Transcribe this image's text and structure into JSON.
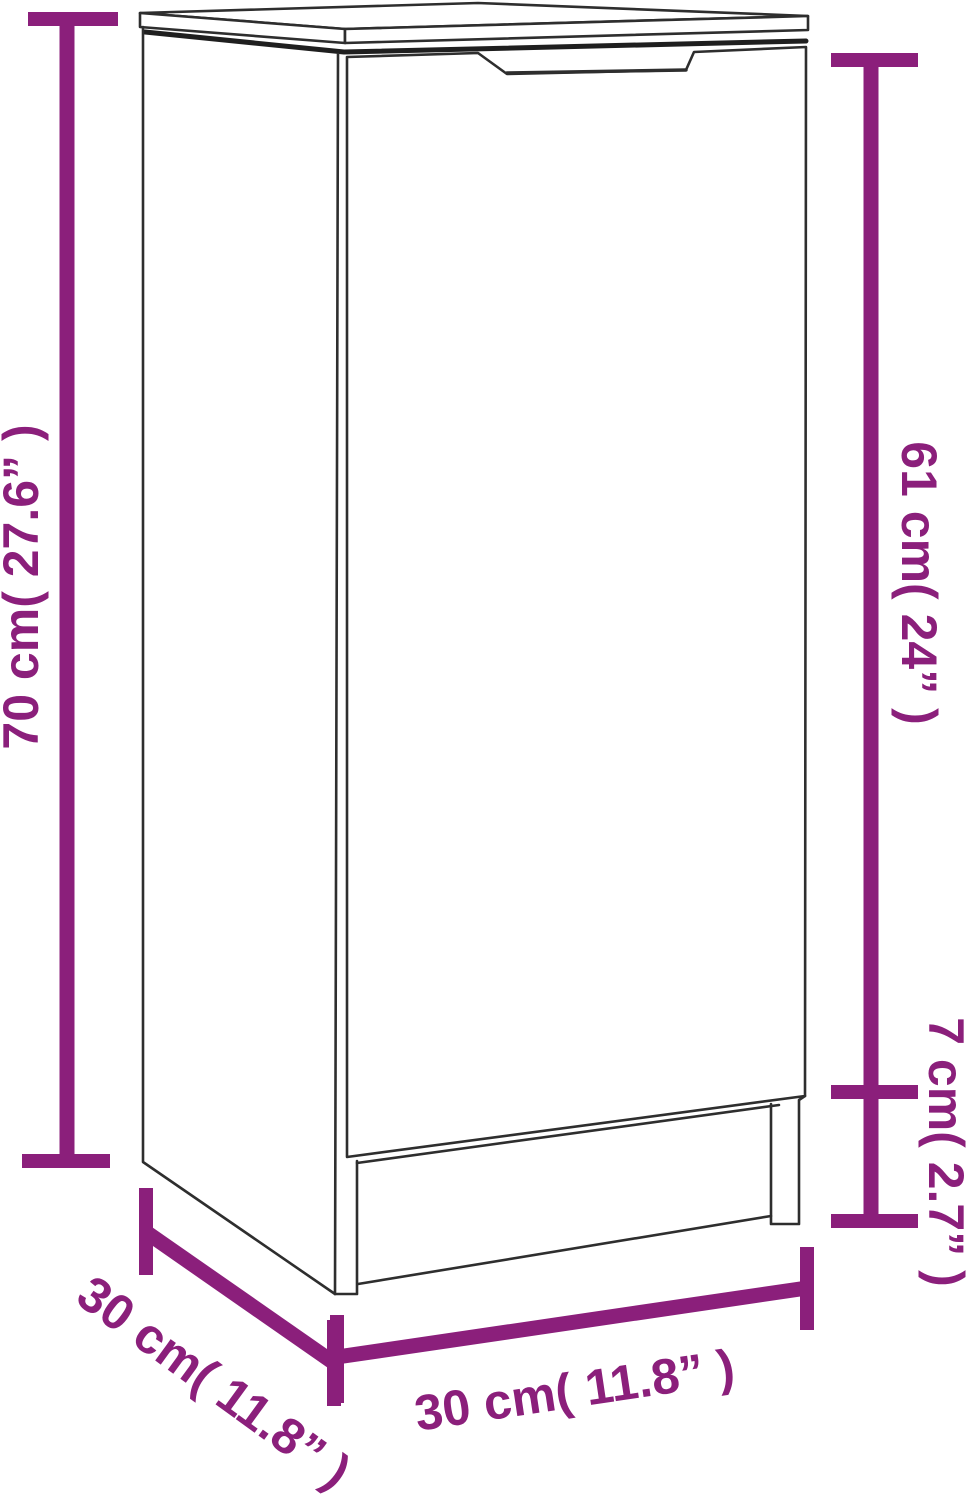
{
  "diagram": {
    "type": "product-dimension-diagram",
    "product": "narrow cabinet / sideboard with door and plinth legs",
    "style": "black line-art on white with magenta dimension lines",
    "colors": {
      "accent": "#8B1F7B",
      "line": "#2e2e2e",
      "line_dark": "#1f1f1f",
      "background": "#ffffff"
    },
    "dimensions": {
      "height_total": {
        "label": "70 cm( 27.6” )",
        "cm": 70,
        "inches": 27.6,
        "placement": "left, vertical, reads bottom-to-top"
      },
      "height_door": {
        "label": "61 cm( 24” )",
        "cm": 61,
        "inches": 24,
        "placement": "right upper, vertical, reads top-to-bottom"
      },
      "height_base": {
        "label": "7 cm( 2.7” )",
        "cm": 7,
        "inches": 2.7,
        "placement": "right lower, vertical, reads top-to-bottom"
      },
      "width": {
        "label": "30 cm( 11.8” )",
        "cm": 30,
        "inches": 11.8,
        "placement": "bottom, slightly tilted"
      },
      "depth": {
        "label": "30 cm( 11.8” )",
        "cm": 30,
        "inches": 11.8,
        "placement": "bottom-left, diagonal"
      }
    }
  }
}
